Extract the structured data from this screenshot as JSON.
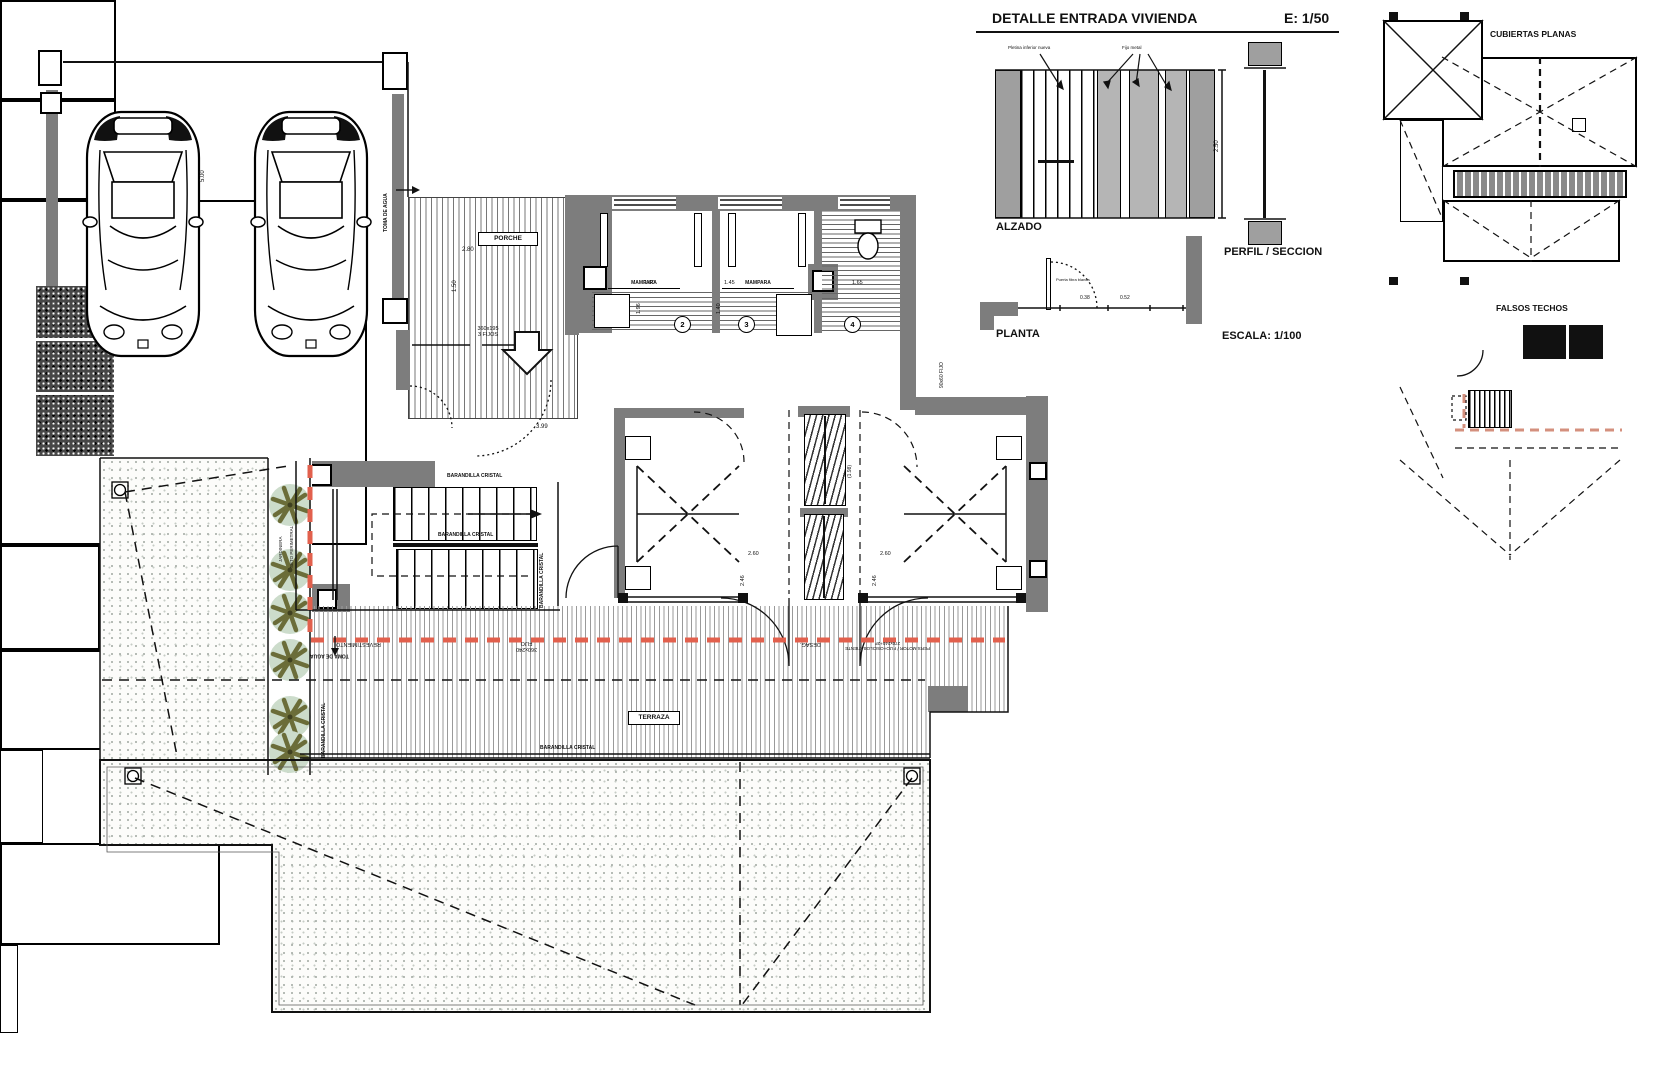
{
  "title_block": {
    "title": "DETALLE ENTRADA VIVIENDA",
    "scale": "E: 1/50",
    "alzado": "ALZADO",
    "perfil": "PERFIL / SECCION",
    "planta": "PLANTA",
    "escala": "ESCALA: 1/100",
    "note_left": "Pletina inferior nueva",
    "note_right": "Fijo metal",
    "planta_note": "Puerta fibra blanca",
    "dim_height": "2.50",
    "dim_a": "0.38",
    "dim_b": "0.52"
  },
  "mini_plans": {
    "cubiertas": "CUBIERTAS PLANAS",
    "falsos": "FALSOS TECHOS"
  },
  "plan": {
    "porche": "PORCHE",
    "terraza": "TERRAZA",
    "toma_de_agua": "TOMA DE AGUA",
    "barandilla_cristal": "BARANDILLA CRISTAL",
    "jardinera": "JARDINERA",
    "seto": "SETO PERIMETRAL",
    "mampara": "MAMPARA",
    "porch_win_1": "360x195",
    "porch_win_2": "3 FIJOS",
    "room_2": "2",
    "room_3": "3",
    "room_4": "4",
    "ann_revestimiento": "REVESTIMIENTO",
    "ann_win_a1": "360x240",
    "ann_win_a2": "FIJO",
    "ann_desag": "DESAG.",
    "ann_win_b1": "PERS.MOTOR / FIJO+OSCILOBATIENTE",
    "ann_win_b2": "270x240+2F",
    "ann_fijo": "90x60 FIJO",
    "dim_5": "5.00",
    "dim_280": "2.80",
    "dim_150": "1.50",
    "dim_399": "3.99",
    "dim_160": "1.60",
    "dim_196": "1.96",
    "dim_145": "1.45",
    "dim_140": "1.40",
    "dim_165": "1.65",
    "dim_260": "2.60",
    "dim_246": "2.46",
    "dim_198": "(1.98)"
  },
  "colors": {
    "wall": "#7d7d7d",
    "red_boundary": "#e2604d",
    "pink_dash": "#d4907e",
    "tree_fill": "#ccdccb",
    "tree_branch": "#6b6d39"
  }
}
